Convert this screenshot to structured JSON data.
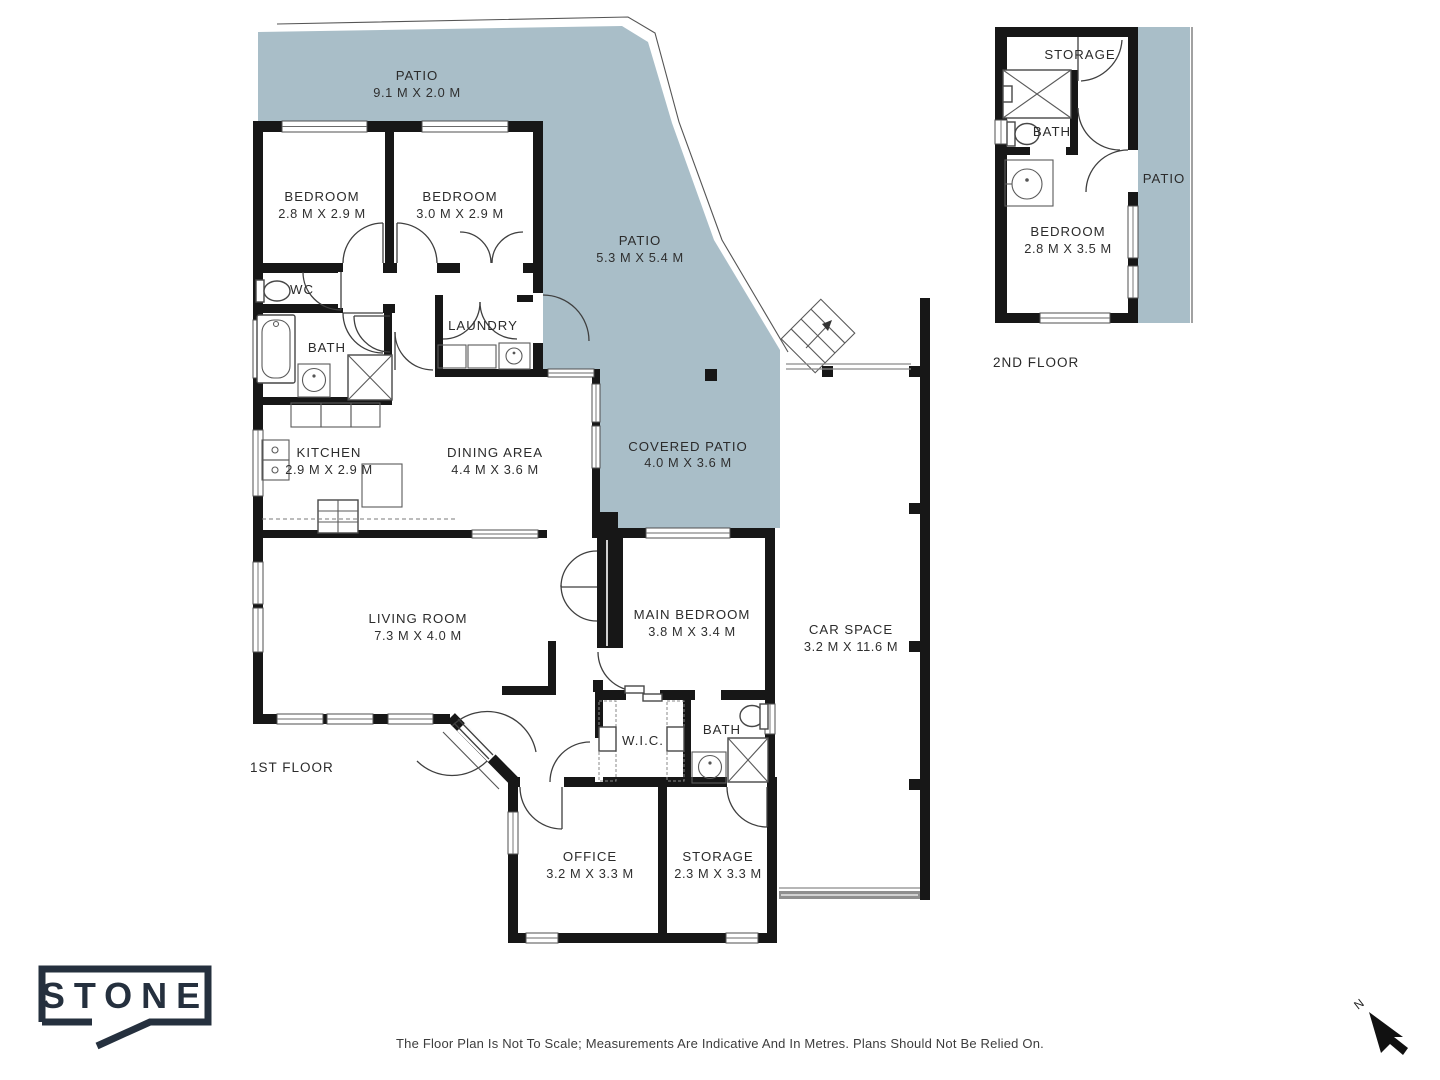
{
  "colors": {
    "patio_fill": "#A9BEC8",
    "wall": "#171717",
    "logo_navy": "#25303E",
    "fence_gray": "#8F8F8F"
  },
  "floor1": {
    "label": "1ST FLOOR",
    "rooms": {
      "patio_top": {
        "name": "PATIO",
        "dims": "9.1 M X 2.0 M"
      },
      "bedroom1": {
        "name": "BEDROOM",
        "dims": "2.8 M X 2.9 M"
      },
      "bedroom2": {
        "name": "BEDROOM",
        "dims": "3.0 M X 2.9 M"
      },
      "patio_side": {
        "name": "PATIO",
        "dims": "5.3 M X 5.4 M"
      },
      "wc": {
        "name": "WC"
      },
      "bath": {
        "name": "BATH"
      },
      "laundry": {
        "name": "LAUNDRY"
      },
      "kitchen": {
        "name": "KITCHEN",
        "dims": "2.9 M X 2.9 M"
      },
      "dining": {
        "name": "DINING AREA",
        "dims": "4.4 M X 3.6 M"
      },
      "covered_patio": {
        "name": "COVERED PATIO",
        "dims": "4.0 M X 3.6 M"
      },
      "living": {
        "name": "LIVING ROOM",
        "dims": "7.3 M X 4.0 M"
      },
      "main_bedroom": {
        "name": "MAIN BEDROOM",
        "dims": "3.8 M X 3.4 M"
      },
      "car_space": {
        "name": "CAR SPACE",
        "dims": "3.2 M X 11.6 M"
      },
      "wic": {
        "name": "W.I.C."
      },
      "bath2": {
        "name": "BATH"
      },
      "office": {
        "name": "OFFICE",
        "dims": "3.2 M X 3.3 M"
      },
      "storage": {
        "name": "STORAGE",
        "dims": "2.3 M X 3.3 M"
      }
    }
  },
  "floor2": {
    "label": "2ND FLOOR",
    "rooms": {
      "storage": {
        "name": "STORAGE"
      },
      "bath": {
        "name": "BATH"
      },
      "patio": {
        "name": "PATIO"
      },
      "bedroom": {
        "name": "BEDROOM",
        "dims": "2.8 M X 3.5 M"
      }
    }
  },
  "branding": {
    "logo_text": "STONE"
  },
  "compass": {
    "label": "N"
  },
  "footer": {
    "disclaimer": "The Floor Plan Is Not To Scale; Measurements Are Indicative And In Metres. Plans Should Not Be Relied On."
  }
}
